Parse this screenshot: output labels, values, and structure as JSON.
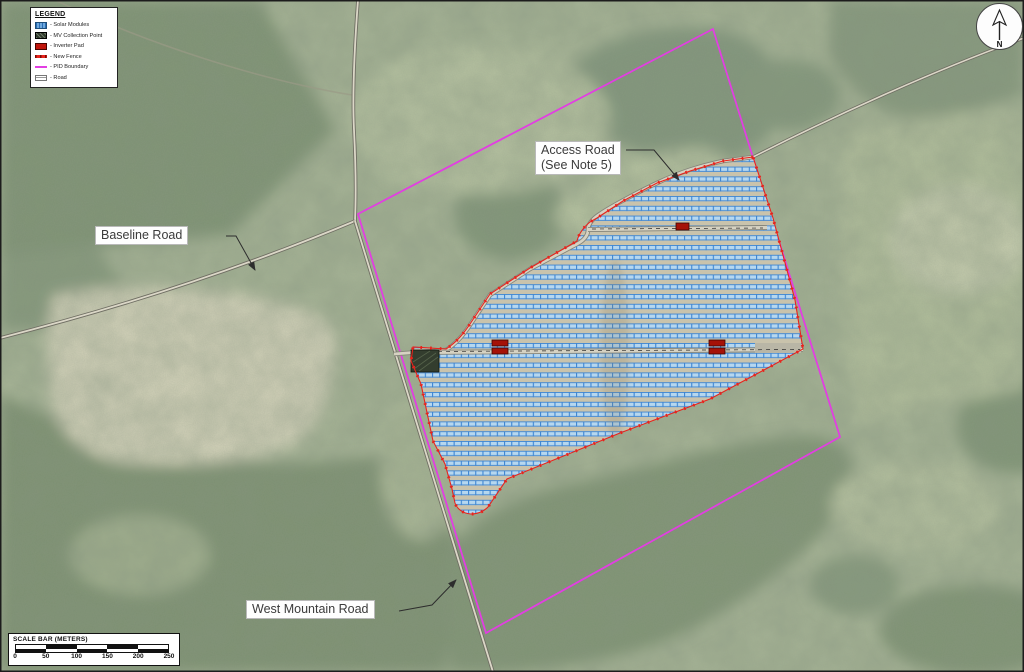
{
  "map": {
    "labels": {
      "baseline_road": "Baseline Road",
      "access_road_line1": "Access Road",
      "access_road_line2": "(See Note 5)",
      "west_mountain_road": "West Mountain Road"
    },
    "north_label": "N"
  },
  "legend": {
    "title": "LEGEND",
    "items": [
      {
        "label": "- Solar Modules",
        "swatch": "solar-modules"
      },
      {
        "label": "- MV Collection Point",
        "swatch": "mv-collection-point"
      },
      {
        "label": "- Inverter Pad",
        "swatch": "inverter-pad"
      },
      {
        "label": "- New Fence",
        "swatch": "new-fence"
      },
      {
        "label": "- PID Boundary",
        "swatch": "pid-boundary"
      },
      {
        "label": "- Road",
        "swatch": "road"
      }
    ]
  },
  "scale_bar": {
    "title": "SCALE BAR (METERS)",
    "ticks": [
      "0",
      "50",
      "100",
      "150",
      "200",
      "250"
    ]
  },
  "colors": {
    "solar_module_fill": "#b6d7ef",
    "solar_module_line": "#3f86d2",
    "fence": "#e8231c",
    "pid_boundary": "#e23ee2",
    "inverter_pad": "#a51208",
    "road_fill": "#dbd7c7",
    "mv_pad": "#333d2e"
  }
}
